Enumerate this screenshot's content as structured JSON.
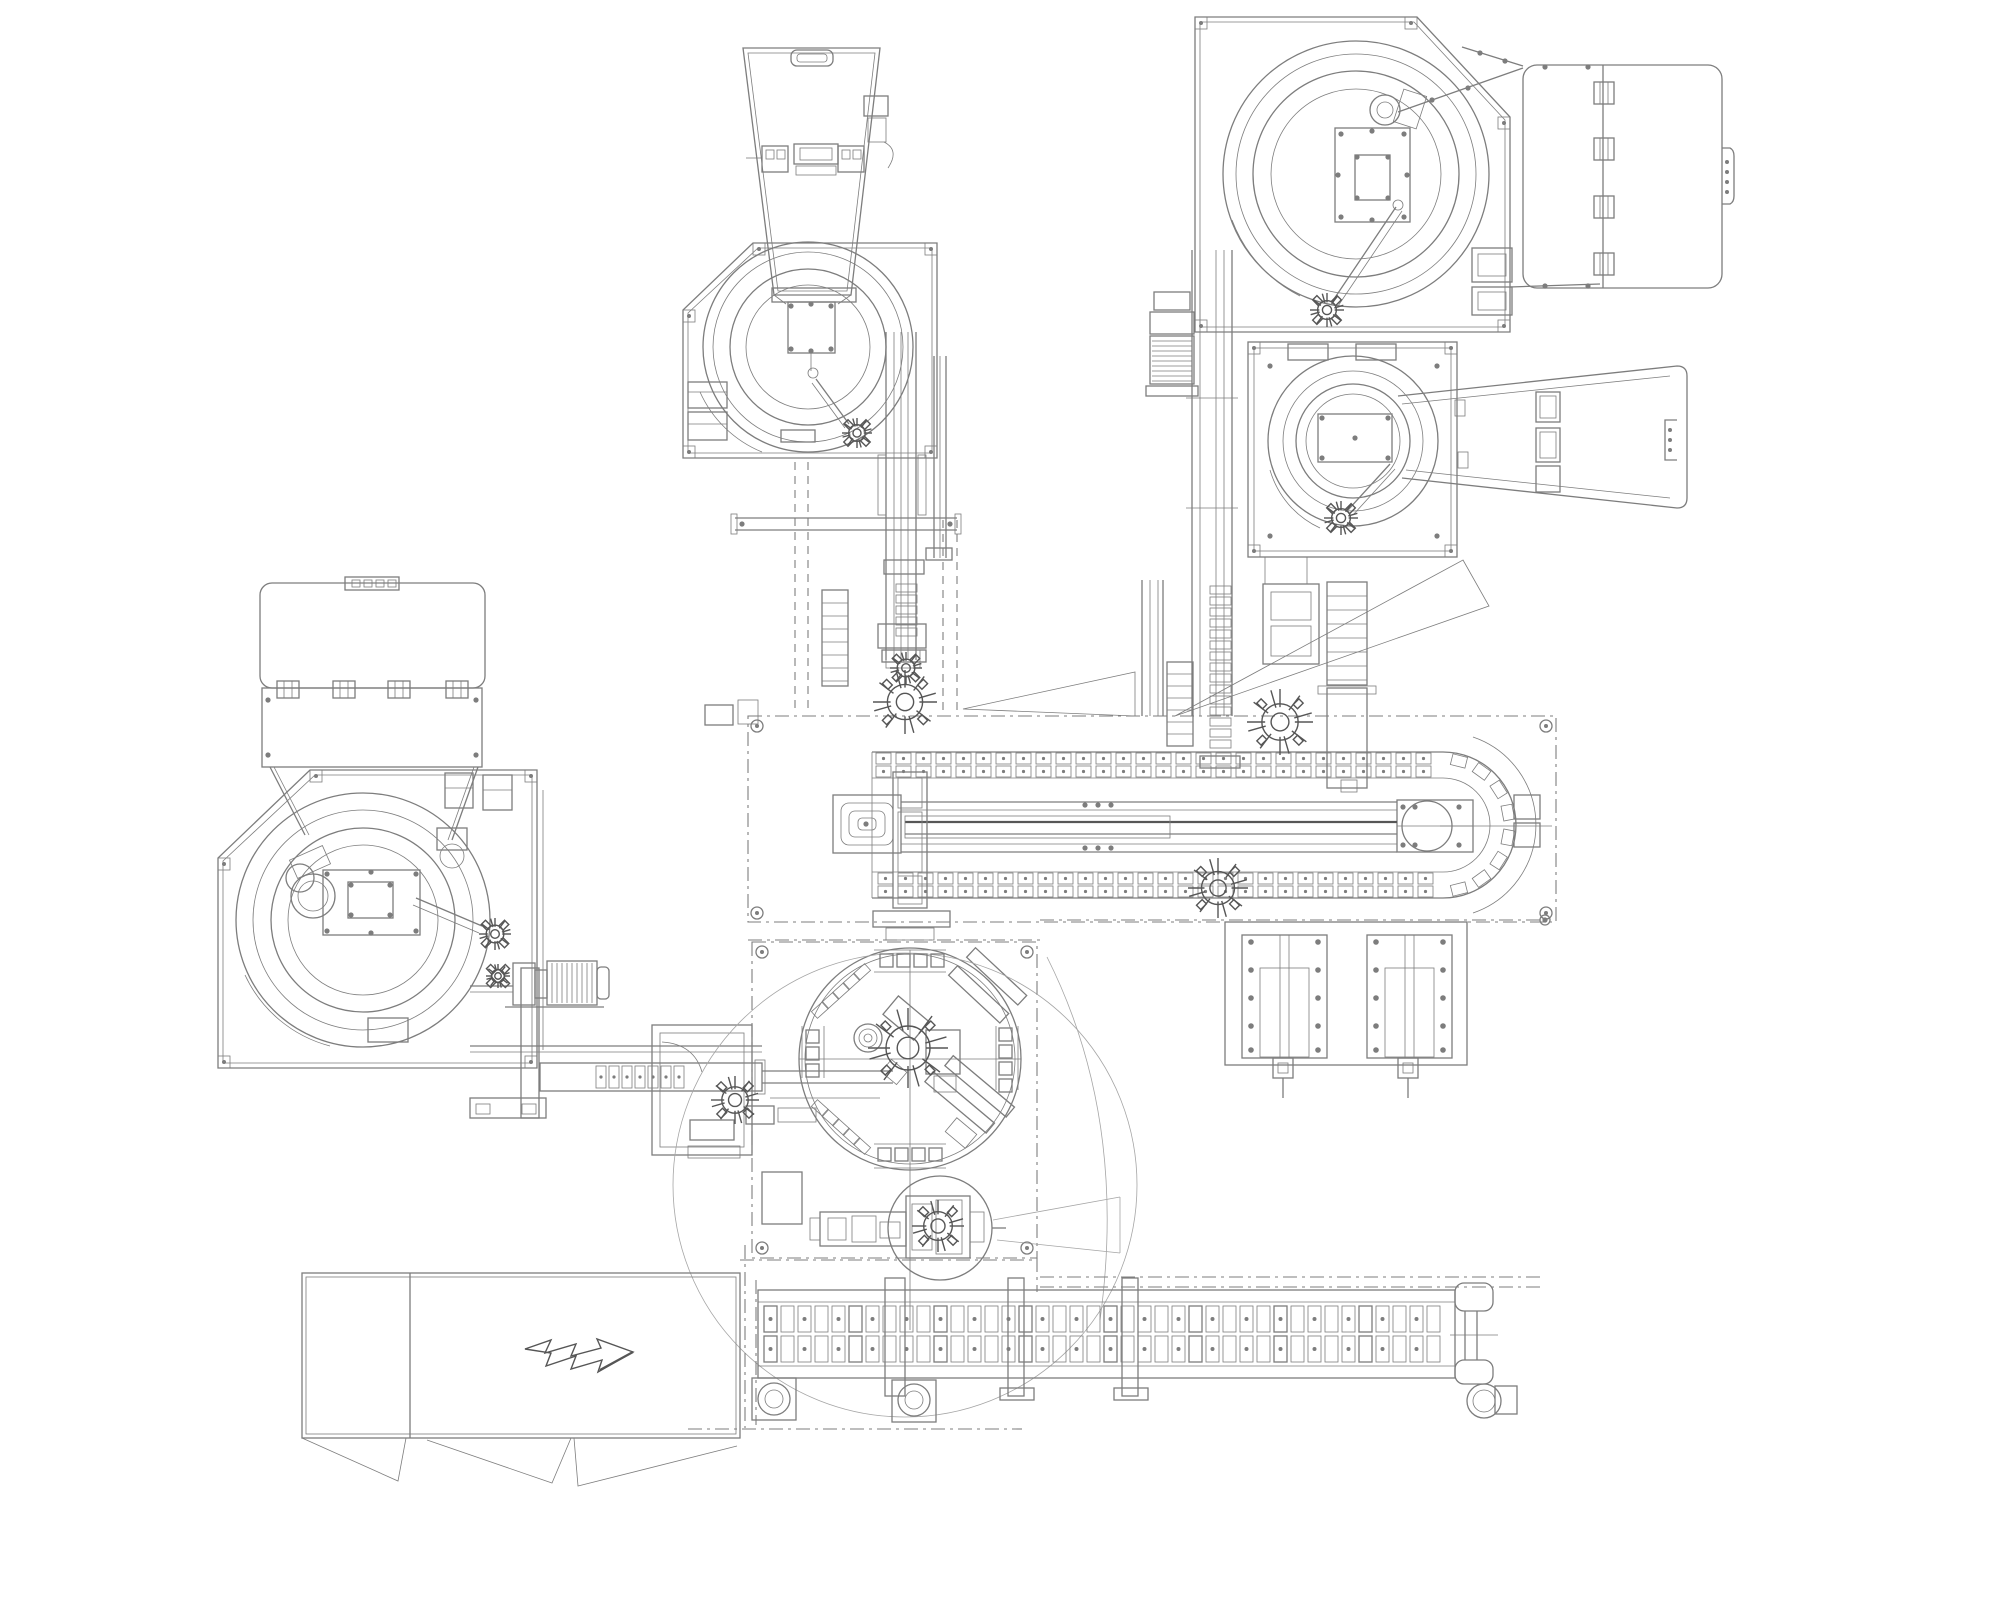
{
  "canvas": {
    "width": 2001,
    "height": 1601
  },
  "palette": {
    "background": "#ffffff",
    "line": "#7d7d7d",
    "line_dark": "#565656",
    "line_light": "#a5a5a5"
  },
  "drawing": {
    "type": "machine-layout-plan-view",
    "components": [
      {
        "id": "hopper-feeder-station",
        "label": "hopper with vibratory bowl feeder",
        "bbox": [
          683,
          40,
          957,
          730
        ]
      },
      {
        "id": "bowl-feeder-top-right",
        "label": "vibratory bowl feeder",
        "bbox": [
          1195,
          17,
          1510,
          332
        ]
      },
      {
        "id": "cover-panel-top-right",
        "label": "hinged cover panel",
        "bbox": [
          1523,
          65,
          1722,
          288
        ]
      },
      {
        "id": "bowl-feeder-mid-right",
        "label": "vibratory bowl feeder",
        "bbox": [
          1248,
          342,
          1457,
          557
        ]
      },
      {
        "id": "discharge-chute-mid-right",
        "label": "open discharge chute",
        "bbox": [
          1398,
          366,
          1687,
          508
        ]
      },
      {
        "id": "cover-panel-left",
        "label": "hinged cover panel",
        "bbox": [
          260,
          577,
          485,
          767
        ]
      },
      {
        "id": "bowl-feeder-left",
        "label": "vibratory bowl feeder",
        "bbox": [
          218,
          770,
          537,
          1068
        ]
      },
      {
        "id": "drive-motor-left",
        "label": "gear motor",
        "bbox": [
          513,
          961,
          609,
          1007
        ]
      },
      {
        "id": "drive-motor-top-right",
        "label": "gear motor",
        "bbox": [
          1146,
          290,
          1198,
          396
        ]
      },
      {
        "id": "infeed-linear-conveyor",
        "label": "linear feed track",
        "bbox": [
          470,
          1046,
          762,
          1120
        ]
      },
      {
        "id": "escapement-station",
        "label": "part escapement frame",
        "bbox": [
          652,
          1025,
          752,
          1155
        ]
      },
      {
        "id": "main-chain-conveyor",
        "label": "pallet chain conveyor loop",
        "bbox": [
          748,
          716,
          1556,
          922
        ]
      },
      {
        "id": "rotary-index-table",
        "label": "rotary indexing dial station",
        "bbox": [
          752,
          942,
          1037,
          1258
        ]
      },
      {
        "id": "slide-plates-unit",
        "label": "twin slide plates",
        "bbox": [
          1225,
          922,
          1467,
          1098
        ]
      },
      {
        "id": "outfeed-chain-conveyor",
        "label": "outfeed mat chain conveyor",
        "bbox": [
          752,
          1283,
          1517,
          1420
        ]
      },
      {
        "id": "discharge-bin",
        "label": "discharge bin with arrow symbol",
        "bbox": [
          302,
          1273,
          740,
          1487
        ]
      }
    ]
  },
  "patterns": {
    "h_chains": [
      {
        "x0": 876,
        "x1": 1434,
        "y": 753,
        "step": 20,
        "w": 15,
        "h": 11,
        "rows": [
          0,
          13
        ]
      },
      {
        "x0": 878,
        "x1": 1434,
        "y": 873,
        "step": 20,
        "w": 15,
        "h": 11,
        "rows": [
          0,
          13
        ]
      },
      {
        "x0": 596,
        "x1": 696,
        "y": 1066,
        "step": 13,
        "w": 10,
        "h": 22,
        "rows": [
          0
        ]
      }
    ],
    "v_chains": [
      {
        "x": 896,
        "y0": 584,
        "y1": 644,
        "step": 11,
        "w": 21,
        "h": 8
      },
      {
        "x": 1210,
        "y0": 586,
        "y1": 750,
        "step": 11,
        "w": 21,
        "h": 8
      }
    ],
    "arc_links": [
      {
        "cx": 1443,
        "cy": 825,
        "r": 66,
        "a0": -76,
        "a1": 76,
        "n": 8,
        "w": 15,
        "h": 11
      }
    ],
    "diag_chains": [
      {
        "x0": 820,
        "y0": 1010,
        "x1": 862,
        "y1": 972,
        "n": 5,
        "w": 15,
        "h": 9
      },
      {
        "x0": 820,
        "y0": 1108,
        "x1": 862,
        "y1": 1146,
        "n": 5,
        "w": 15,
        "h": 9
      }
    ],
    "belt_grid": {
      "x0": 764,
      "x1": 1442,
      "step": 17,
      "w": 13,
      "rows": [
        {
          "y": 1306,
          "h": 26
        },
        {
          "y": 1336,
          "h": 26
        }
      ]
    },
    "gear_clusters": [
      [
        905,
        702,
        32
      ],
      [
        1280,
        722,
        33
      ],
      [
        1218,
        888,
        30
      ],
      [
        857,
        433,
        15
      ],
      [
        1327,
        310,
        17
      ],
      [
        1341,
        518,
        17
      ],
      [
        495,
        934,
        16
      ],
      [
        498,
        976,
        12
      ],
      [
        908,
        1048,
        40
      ],
      [
        938,
        1226,
        26
      ],
      [
        735,
        1100,
        24
      ],
      [
        906,
        668,
        16
      ]
    ],
    "ladders": [
      {
        "x": 822,
        "y": 590,
        "w": 26,
        "h": 96,
        "step": 13
      },
      {
        "x": 1327,
        "y": 582,
        "w": 40,
        "h": 103,
        "step": 14
      },
      {
        "x": 1167,
        "y": 662,
        "w": 26,
        "h": 84,
        "step": 12
      }
    ],
    "station_squares": [
      {
        "x": 880,
        "y": 954,
        "n": 4,
        "dx": 17,
        "dy": 0,
        "s": 13
      },
      {
        "x": 878,
        "y": 1148,
        "n": 4,
        "dx": 17,
        "dy": 0,
        "s": 13
      },
      {
        "x": 806,
        "y": 1030,
        "n": 3,
        "dx": 0,
        "dy": 17,
        "s": 13
      },
      {
        "x": 999,
        "y": 1028,
        "n": 4,
        "dx": 0,
        "dy": 17,
        "s": 13
      }
    ],
    "motors": [
      {
        "x": 1150,
        "y": 336,
        "w": 44,
        "h": 48,
        "fins": "h"
      },
      {
        "x": 547,
        "y": 961,
        "w": 50,
        "h": 44,
        "fins": "v"
      }
    ],
    "slide_plates": {
      "frame": [
        1225,
        922,
        242,
        143
      ],
      "plates": [
        [
          1242,
          935,
          85,
          123
        ],
        [
          1367,
          935,
          85,
          123
        ]
      ],
      "bolt_ys": [
        942,
        970,
        998,
        1026,
        1050
      ]
    },
    "corner_screws": [
      [
        759,
        249
      ],
      [
        931,
        249
      ],
      [
        931,
        452
      ],
      [
        689,
        452
      ],
      [
        689,
        316
      ],
      [
        1201,
        23
      ],
      [
        1411,
        23
      ],
      [
        1504,
        123
      ],
      [
        1504,
        326
      ],
      [
        1201,
        326
      ],
      [
        1254,
        348
      ],
      [
        1451,
        348
      ],
      [
        1254,
        551
      ],
      [
        1451,
        551
      ],
      [
        316,
        776
      ],
      [
        531,
        776
      ],
      [
        531,
        1062
      ],
      [
        224,
        1062
      ],
      [
        224,
        864
      ]
    ],
    "corner_bolts": [
      [
        757,
        726
      ],
      [
        1546,
        726
      ],
      [
        757,
        913
      ],
      [
        1546,
        913
      ],
      [
        762,
        952
      ],
      [
        1027,
        952
      ],
      [
        762,
        1248
      ],
      [
        1027,
        1248
      ]
    ],
    "bolt_dots": [
      [
        791,
        306
      ],
      [
        811,
        304
      ],
      [
        831,
        306
      ],
      [
        791,
        349
      ],
      [
        811,
        351
      ],
      [
        831,
        349
      ],
      [
        1341,
        134
      ],
      [
        1372,
        131
      ],
      [
        1404,
        134
      ],
      [
        1341,
        217
      ],
      [
        1372,
        220
      ],
      [
        1404,
        217
      ],
      [
        1338,
        175
      ],
      [
        1407,
        175
      ],
      [
        1357,
        157
      ],
      [
        1388,
        157
      ],
      [
        1357,
        198
      ],
      [
        1388,
        198
      ],
      [
        1322,
        418
      ],
      [
        1388,
        418
      ],
      [
        1322,
        458
      ],
      [
        1388,
        458
      ],
      [
        1355,
        438
      ],
      [
        327,
        874
      ],
      [
        416,
        874
      ],
      [
        327,
        931
      ],
      [
        416,
        931
      ],
      [
        371,
        872
      ],
      [
        371,
        933
      ],
      [
        351,
        885
      ],
      [
        390,
        885
      ],
      [
        351,
        915
      ],
      [
        390,
        915
      ],
      [
        1403,
        807
      ],
      [
        1459,
        807
      ],
      [
        1403,
        845
      ],
      [
        1459,
        845
      ],
      [
        1415,
        807
      ],
      [
        1415,
        845
      ],
      [
        1085,
        805
      ],
      [
        1098,
        805
      ],
      [
        1111,
        805
      ],
      [
        1085,
        848
      ],
      [
        1098,
        848
      ],
      [
        1111,
        848
      ],
      [
        1545,
        67
      ],
      [
        1588,
        67
      ],
      [
        1545,
        286
      ],
      [
        1588,
        286
      ],
      [
        1480,
        53
      ],
      [
        1505,
        61
      ],
      [
        1432,
        100
      ],
      [
        1468,
        88
      ],
      [
        268,
        700
      ],
      [
        268,
        755
      ],
      [
        476,
        700
      ],
      [
        476,
        755
      ],
      [
        742,
        524
      ],
      [
        950,
        524
      ],
      [
        1270,
        366
      ],
      [
        1437,
        366
      ],
      [
        1270,
        536
      ],
      [
        1437,
        536
      ],
      [
        1545,
        920
      ],
      [
        866,
        824
      ]
    ]
  }
}
